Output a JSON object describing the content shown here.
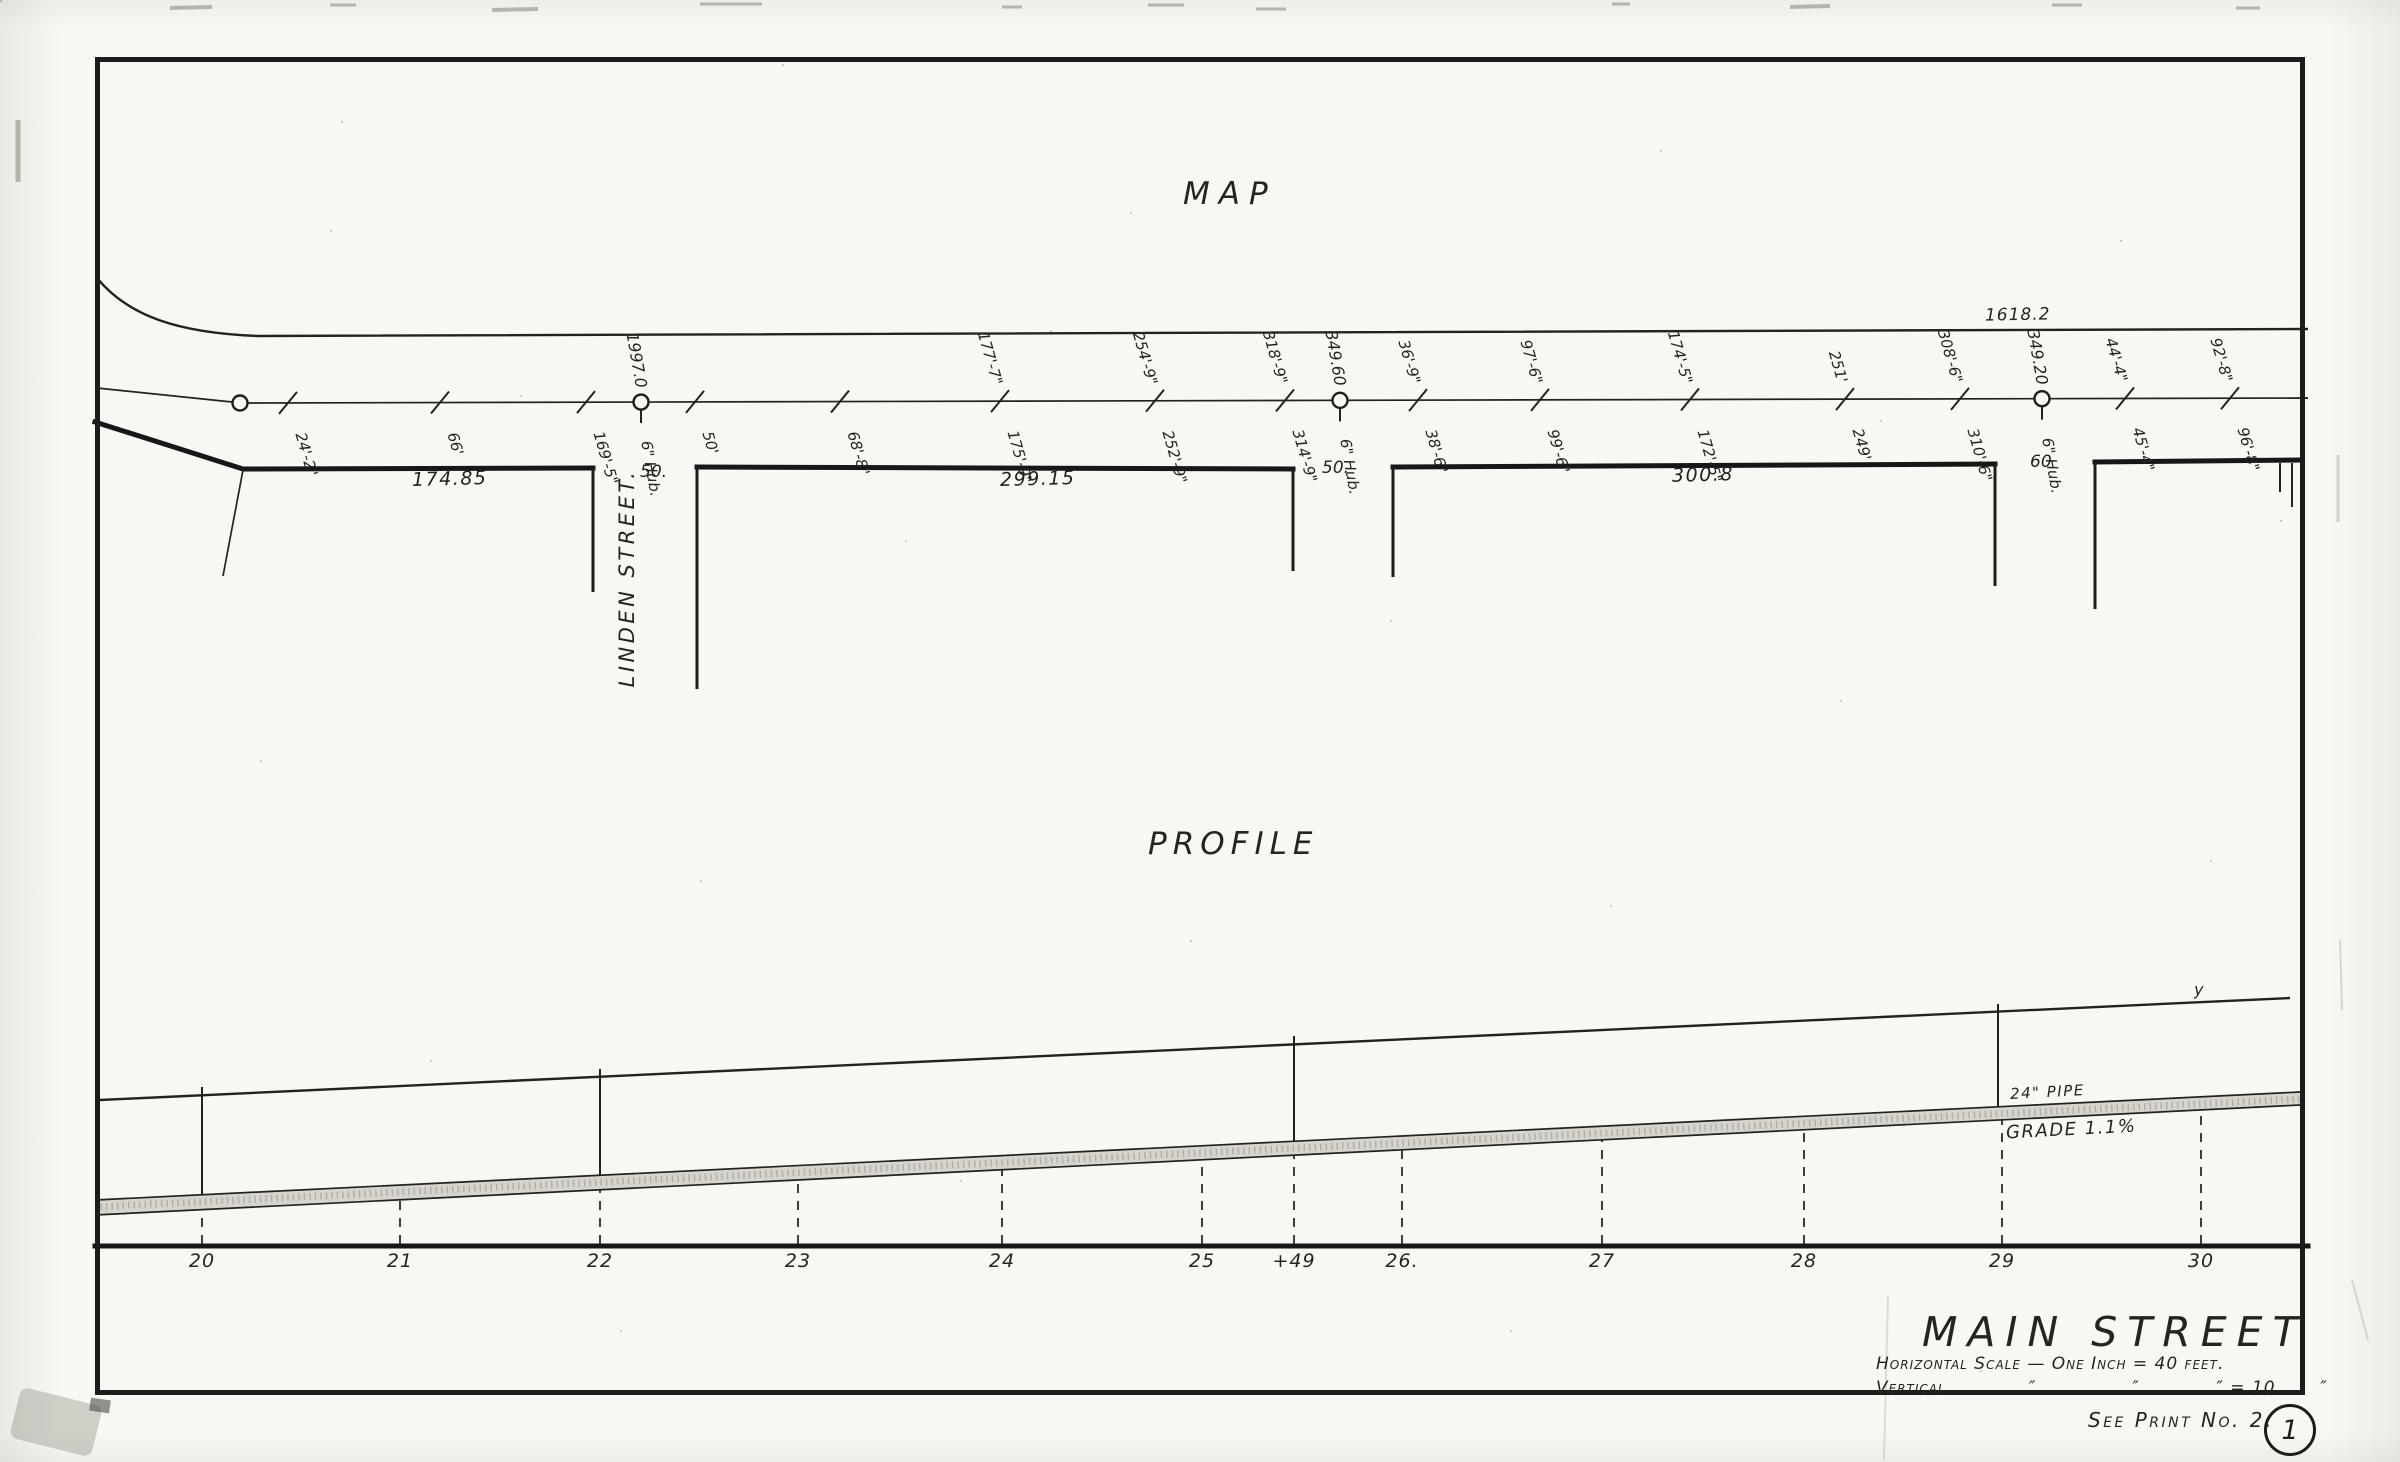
{
  "map_section": {
    "title": "MAP",
    "top_line_distance": "1618.2",
    "linden_street_label": "LINDEN STREET.",
    "linden_width_label": "50.",
    "frontage_labels": [
      {
        "text": "174.85",
        "x": 412,
        "y": 468
      },
      {
        "text": "299.15",
        "x": 1000,
        "y": 468
      },
      {
        "text": "300.8",
        "x": 1672,
        "y": 464
      }
    ],
    "gap_width_labels": [
      {
        "text": "50.",
        "x": 1322,
        "y": 458
      },
      {
        "text": "60",
        "x": 2030,
        "y": 452
      }
    ],
    "centerline_annotations": [
      {
        "x": 288,
        "below": "24'-2\""
      },
      {
        "x": 440,
        "below": "66'"
      },
      {
        "x": 586,
        "below": "169'-5\""
      },
      {
        "x": 641,
        "hub": true,
        "above": "1997.0",
        "below": "6\" Hub."
      },
      {
        "x": 695,
        "below": "50'"
      },
      {
        "x": 840,
        "below": "68'-8\""
      },
      {
        "x": 1000,
        "above": "177'-7\"",
        "below": "175'-9\""
      },
      {
        "x": 1155,
        "above": "254'-9\"",
        "below": "252'-9\""
      },
      {
        "x": 1285,
        "above": "318'-9\"",
        "below": "314'-9\""
      },
      {
        "x": 1340,
        "hub": true,
        "above": "349.60",
        "below": "6\" Hub."
      },
      {
        "x": 1418,
        "above": "36'-9\"",
        "below": "38'-6\""
      },
      {
        "x": 1540,
        "above": "97'-6\"",
        "below": "99'-6\""
      },
      {
        "x": 1690,
        "above": "174'-5\"",
        "below": "172'-5\""
      },
      {
        "x": 1845,
        "above": "251'",
        "below": "249'"
      },
      {
        "x": 1960,
        "above": "308'-6\"",
        "below": "310'-6\""
      },
      {
        "x": 2042,
        "hub": true,
        "above": "349.20",
        "below": "6\" Hub."
      },
      {
        "x": 2125,
        "above": "44'-4\"",
        "below": "45'-4\""
      },
      {
        "x": 2230,
        "above": "92'-8\"",
        "below": "96'-8\""
      }
    ]
  },
  "profile_section": {
    "title": "PROFILE",
    "pipe_label": "24\" PIPE",
    "grade_label": "GRADE 1.1%",
    "surface_mark": "y",
    "stations": [
      {
        "x": 202,
        "label": "20"
      },
      {
        "x": 400,
        "label": "21"
      },
      {
        "x": 600,
        "label": "22"
      },
      {
        "x": 798,
        "label": "23"
      },
      {
        "x": 1002,
        "label": "24"
      },
      {
        "x": 1202,
        "label": "25"
      },
      {
        "x": 1294,
        "label": "+49"
      },
      {
        "x": 1402,
        "label": "26."
      },
      {
        "x": 1602,
        "label": "27"
      },
      {
        "x": 1804,
        "label": "28"
      },
      {
        "x": 2002,
        "label": "29"
      },
      {
        "x": 2201,
        "label": "30"
      }
    ]
  },
  "title_block": {
    "street_name": "MAIN STREET",
    "scale_line1": "Horizontal Scale — One Inch = 40 feet.",
    "scale_line2": "Vertical             ″               ″            ″ = 10       ″",
    "see_print": "See Print No. 2.",
    "sheet_number": "1"
  }
}
